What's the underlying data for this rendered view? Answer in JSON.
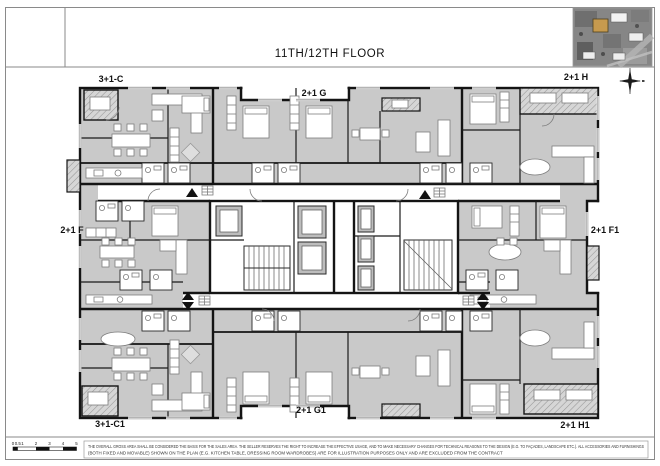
{
  "header": {
    "title": "11TH/12TH FLOOR"
  },
  "units": [
    {
      "label": "3+1-C"
    },
    {
      "label": "2+1 G"
    },
    {
      "label": "2+1 H"
    },
    {
      "label": "2+1 F"
    },
    {
      "label": "2+1 F1"
    },
    {
      "label": "3+1-C1"
    },
    {
      "label": "2+1 G1"
    },
    {
      "label": "2+1 H1"
    }
  ],
  "scale_bar": {
    "labels": [
      "0",
      "0.5",
      "1",
      "2",
      "3",
      "4",
      "5"
    ]
  },
  "disclaimer": {
    "line1": "THE OVERALL GROSS AREA SHALL BE CONSIDERED THE BASIS FOR THE SALES AREA. THE SELLER RESERVES THE RIGHT TO INCREASE THE EFFECTIVE USAGE, AND TO MAKE NECESSARY CHANGES FOR TECHNICAL REASONS TO THE DESIGN (E.G. TO FAÇADES, LANDSCAPE ETC.). ALL ACCESSORIES AND FURNISHINGS",
    "line2": "(BOTH FIXED AND MOVABLE) SHOWN ON THE PLAN (E.G. KITCHEN TABLE, DRESSING ROOM WARDROBES) ARE FOR ILLUSTRATION PURPOSES ONLY AND ARE EXCLUDED FROM THE CONTRACT"
  },
  "colors": {
    "room_fill": "#c9c9c9",
    "wall": "#141414",
    "map_highlight": "#c79a4e"
  }
}
